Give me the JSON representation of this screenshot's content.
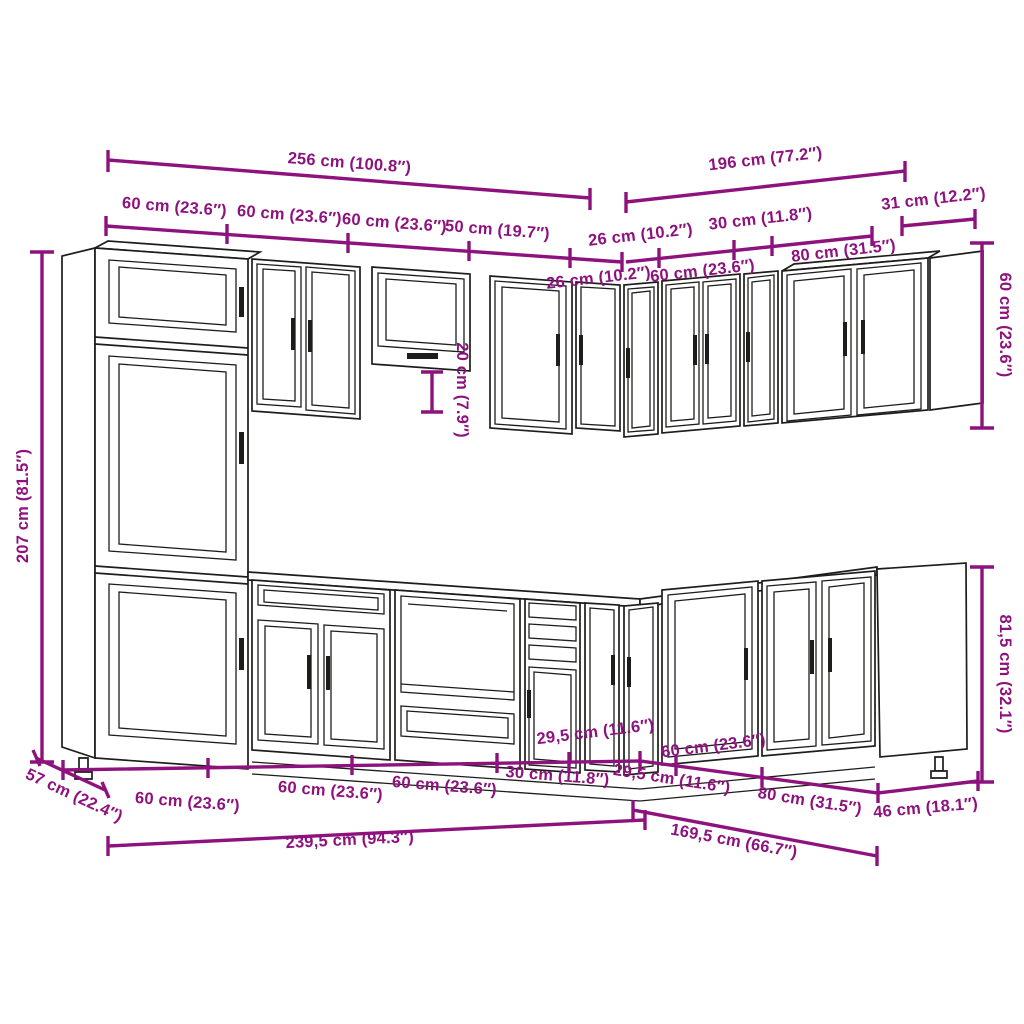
{
  "page": {
    "background": "#ffffff"
  },
  "diagram": {
    "type": "kitchen-cabinet-set-dimension-drawing",
    "accent_color": "#8e127e",
    "line_color": "#1d1d1b",
    "labels": {
      "total_top_left": "256 cm (100.8″)",
      "total_top_right": "196 cm (77.2″)",
      "wall_60_a": "60 cm (23.6″)",
      "wall_60_b": "60 cm (23.6″)",
      "wall_60_c": "60 cm (23.6″)",
      "wall_50": "50 cm (19.7″)",
      "wall_26_a": "26 cm (10.2″)",
      "wall_30": "30 cm (11.8″)",
      "wall_31": "31 cm (12.2″)",
      "wall_26_b": "26 cm (10.2″)",
      "wall_60_d": "60 cm (23.6″)",
      "wall_80": "80 cm (31.5″)",
      "height_tall": "207 cm (81.5″)",
      "height_wall": "60 cm (23.6″)",
      "gap_hood": "20 cm (7.9″)",
      "height_base": "81,5 cm (32.1″)",
      "depth_left": "57 cm (22.4″)",
      "base_60_a": "60 cm (23.6″)",
      "base_60_b": "60 cm (23.6″)",
      "base_60_c": "60 cm (23.6″)",
      "base_30": "30 cm (11.8″)",
      "base_295_a": "29,5 cm (11.6″)",
      "base_295_b": "29,5 cm (11.6″)",
      "base_60_d": "60 cm (23.6″)",
      "base_80": "80 cm (31.5″)",
      "base_46": "46 cm (18.1″)",
      "total_bottom_left": "239,5 cm (94.3″)",
      "total_bottom_right": "169,5 cm (66.7″)"
    }
  }
}
